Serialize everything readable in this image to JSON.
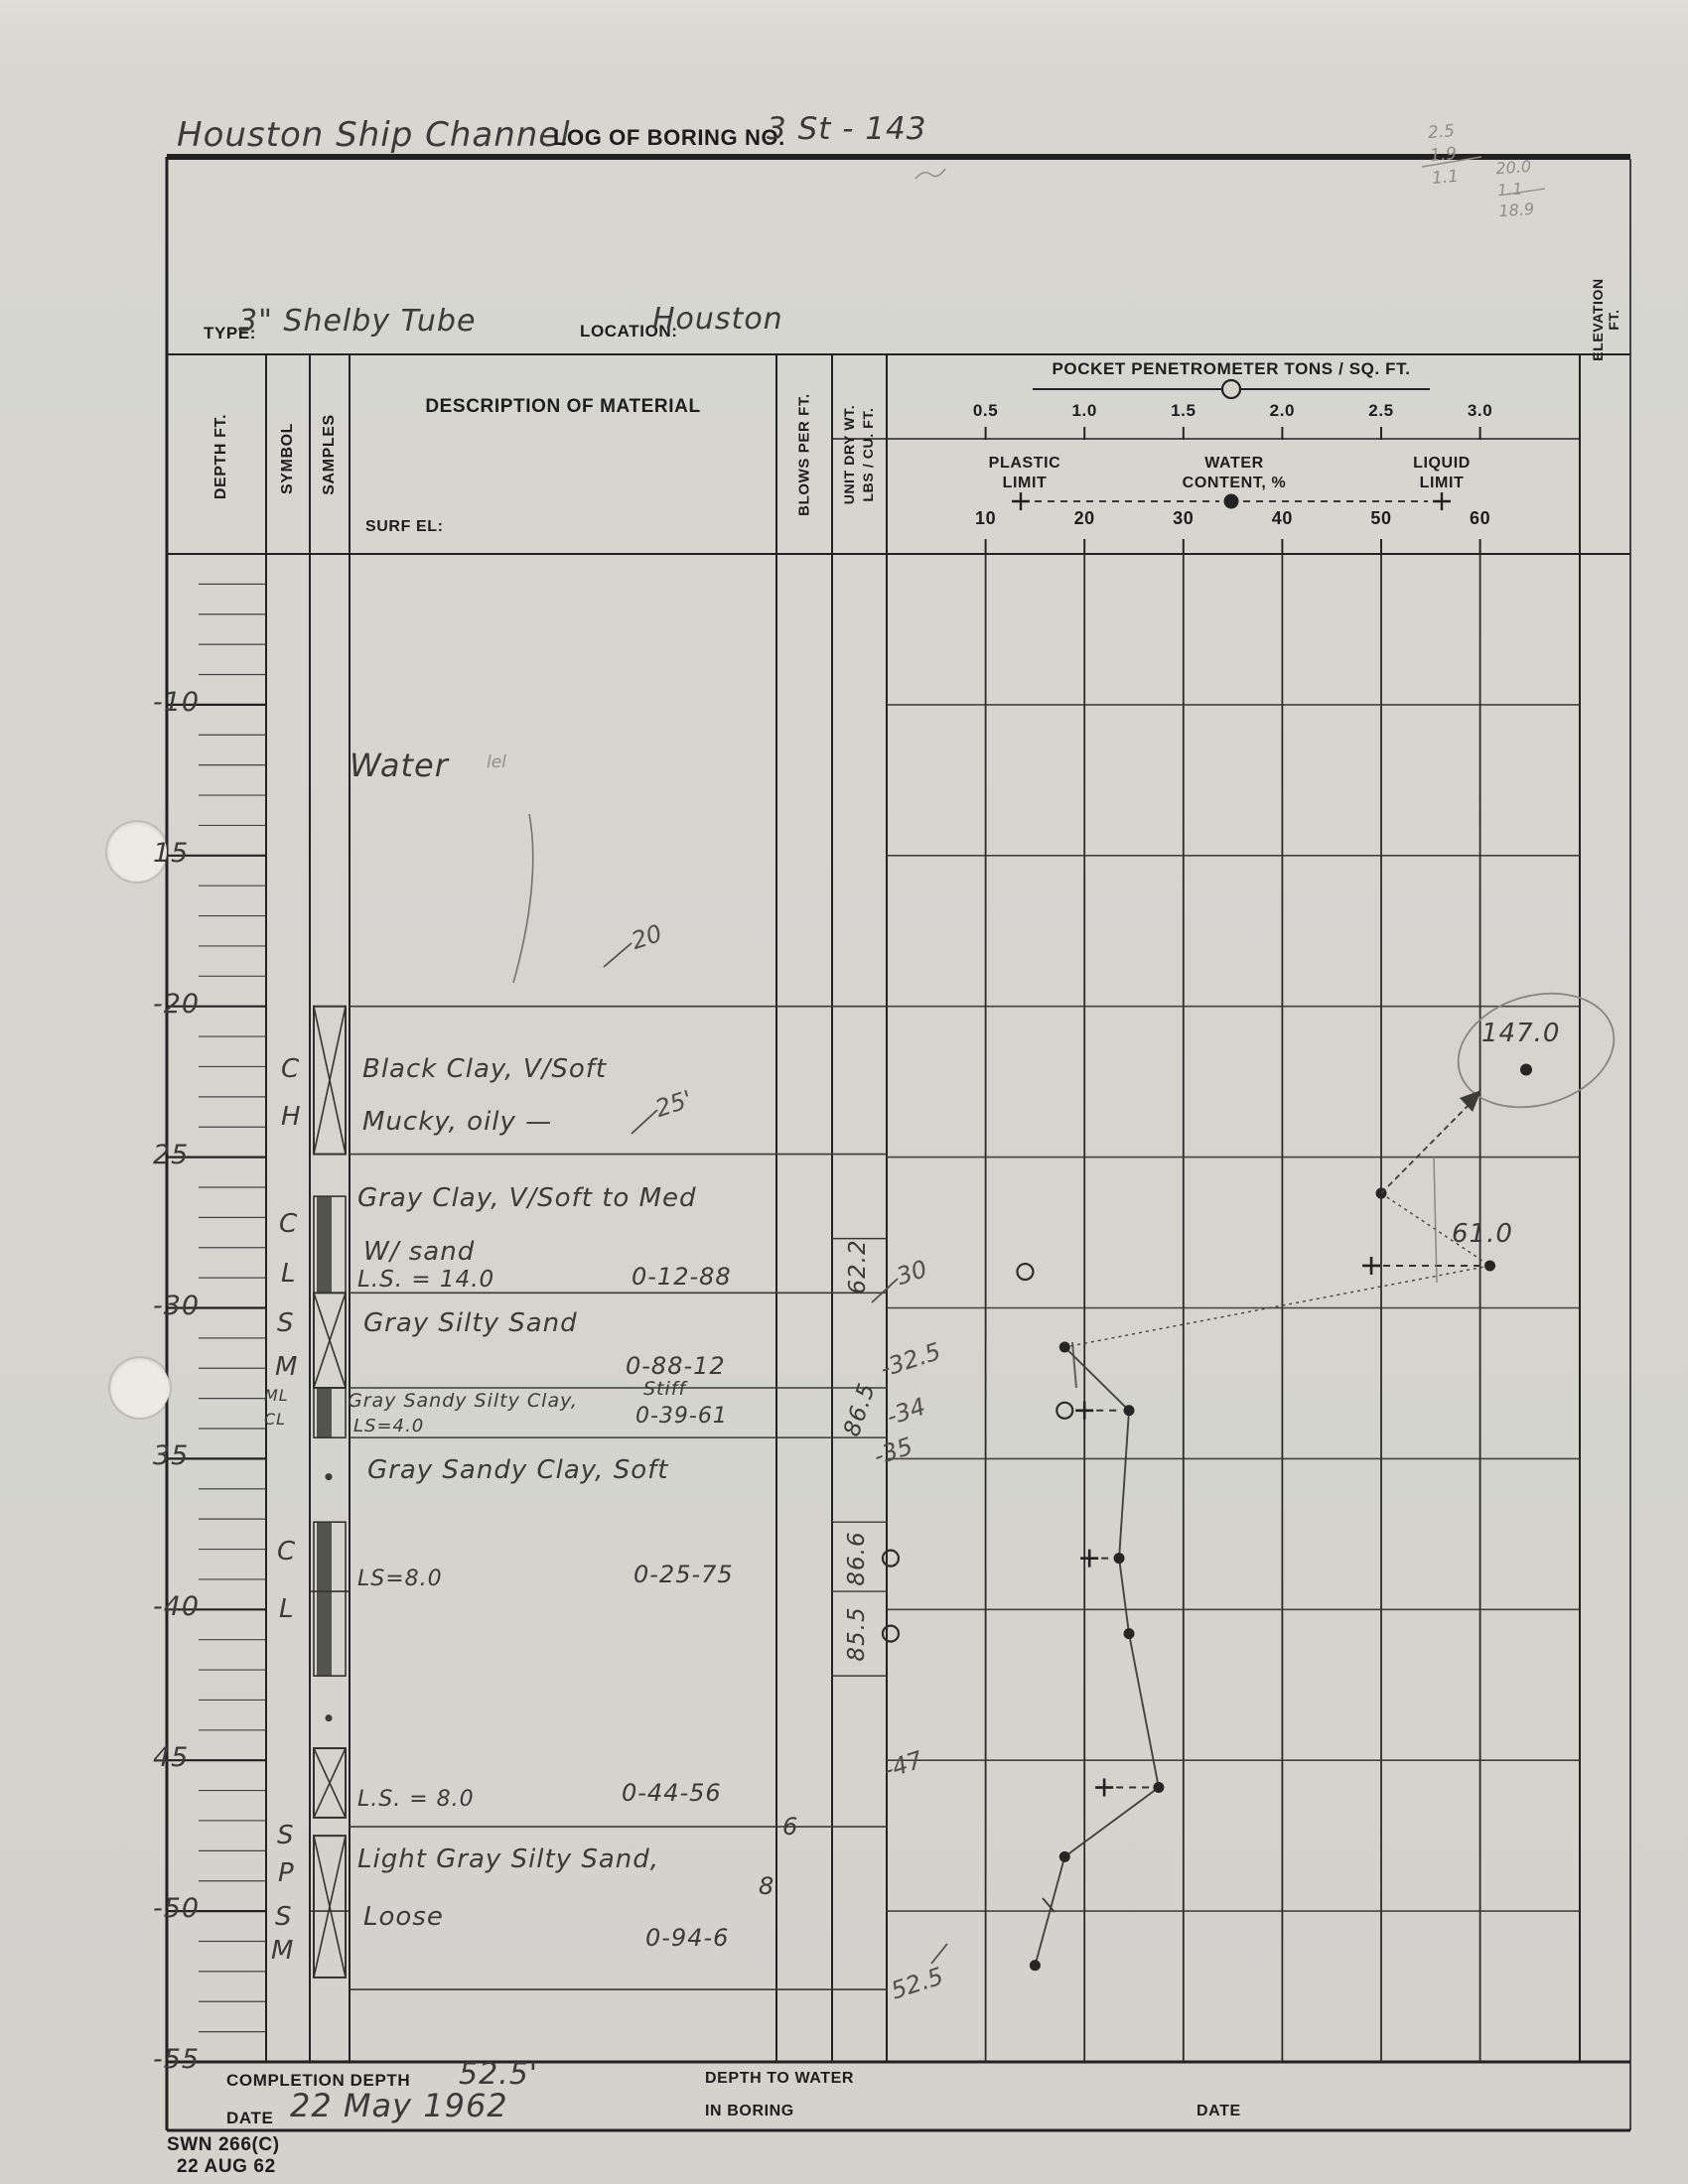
{
  "title": {
    "project": "Houston Ship Channel",
    "boring_label": "LOG OF BORING NO.",
    "boring_no": "3 St - 143"
  },
  "pencil_notes_top": {
    "col1": [
      "2.5",
      "1.9",
      "1.1"
    ],
    "col2": [
      "20.0",
      "1.1",
      "18.9"
    ]
  },
  "type_row": {
    "type_label": "TYPE:",
    "type_value": "3\" Shelby Tube",
    "location_label": "LOCATION:",
    "location_value": "Houston"
  },
  "header": {
    "depth": "DEPTH FT.",
    "symbol": "SYMBOL",
    "samples": "SAMPLES",
    "description": "DESCRIPTION OF MATERIAL",
    "surf_el": "SURF EL:",
    "blows": "BLOWS PER FT.",
    "unit_dry_wt": "UNIT DRY WT.\nLBS / CU. FT.",
    "elevation": "ELEVATION FT.",
    "pen_title": "POCKET PENETROMETER  TONS / SQ. FT.",
    "plastic_limit": "PLASTIC\nLIMIT",
    "water_content": "WATER\nCONTENT, %",
    "liquid_limit": "LIQUID\nLIMIT"
  },
  "depth_labels": [
    {
      "d": 10,
      "t": "-10"
    },
    {
      "d": 15,
      "t": "15"
    },
    {
      "d": 20,
      "t": "-20"
    },
    {
      "d": 25,
      "t": "25"
    },
    {
      "d": 30,
      "t": "-30"
    },
    {
      "d": 35,
      "t": "35"
    },
    {
      "d": 40,
      "t": "-40"
    },
    {
      "d": 45,
      "t": "45"
    },
    {
      "d": 50,
      "t": "-50"
    },
    {
      "d": 55,
      "t": "-55"
    }
  ],
  "log": {
    "entries": [
      {
        "t": "Water",
        "x": 352,
        "y": 752,
        "fs": 32,
        "cls": "hw"
      },
      {
        "t": "lel",
        "x": 490,
        "y": 758,
        "fs": 17,
        "cls": "pencil"
      },
      {
        "t": "Black Clay, V/Soft",
        "x": 365,
        "y": 1062,
        "fs": 26,
        "cls": "hw"
      },
      {
        "t": "Mucky, oily —",
        "x": 365,
        "y": 1115,
        "fs": 26,
        "cls": "hw"
      },
      {
        "t": "Gray Clay, V/Soft to Med",
        "x": 360,
        "y": 1192,
        "fs": 26,
        "cls": "hw"
      },
      {
        "t": "W/ sand",
        "x": 366,
        "y": 1246,
        "fs": 26,
        "cls": "hw"
      },
      {
        "t": "L.S. = 14.0",
        "x": 360,
        "y": 1276,
        "fs": 23,
        "cls": "hw"
      },
      {
        "t": "0-12-88",
        "x": 636,
        "y": 1272,
        "fs": 24,
        "cls": "hw"
      },
      {
        "t": "Gray Silty Sand",
        "x": 366,
        "y": 1318,
        "fs": 26,
        "cls": "hw"
      },
      {
        "t": "0-88-12",
        "x": 630,
        "y": 1362,
        "fs": 24,
        "cls": "hw"
      },
      {
        "t": "Gray Sandy Silty Clay,",
        "x": 350,
        "y": 1400,
        "fs": 19,
        "cls": "hw"
      },
      {
        "t": "Stiff",
        "x": 648,
        "y": 1388,
        "fs": 19,
        "cls": "hw"
      },
      {
        "t": "LS=4.0",
        "x": 356,
        "y": 1426,
        "fs": 18,
        "cls": "hw"
      },
      {
        "t": "0-39-61",
        "x": 640,
        "y": 1414,
        "fs": 22,
        "cls": "hw"
      },
      {
        "t": "Gray Sandy Clay, Soft",
        "x": 370,
        "y": 1466,
        "fs": 26,
        "cls": "hw"
      },
      {
        "t": "LS=8.0",
        "x": 360,
        "y": 1578,
        "fs": 22,
        "cls": "hw"
      },
      {
        "t": "0-25-75",
        "x": 638,
        "y": 1572,
        "fs": 24,
        "cls": "hw"
      },
      {
        "t": "L.S. = 8.0",
        "x": 360,
        "y": 1800,
        "fs": 22,
        "cls": "hw"
      },
      {
        "t": "0-44-56",
        "x": 626,
        "y": 1792,
        "fs": 24,
        "cls": "hw"
      },
      {
        "t": "6",
        "x": 788,
        "y": 1826,
        "fs": 24,
        "cls": "hw"
      },
      {
        "t": "Light Gray Silty Sand,",
        "x": 360,
        "y": 1858,
        "fs": 26,
        "cls": "hw"
      },
      {
        "t": "Loose",
        "x": 366,
        "y": 1916,
        "fs": 26,
        "cls": "hw"
      },
      {
        "t": "8",
        "x": 764,
        "y": 1886,
        "fs": 24,
        "cls": "hw"
      },
      {
        "t": "0-94-6",
        "x": 650,
        "y": 1938,
        "fs": 24,
        "cls": "hw"
      }
    ],
    "symbols": [
      {
        "t": "C",
        "x": 283,
        "y": 1062,
        "fs": 26
      },
      {
        "t": "H",
        "x": 283,
        "y": 1110,
        "fs": 26
      },
      {
        "t": "C",
        "x": 281,
        "y": 1218,
        "fs": 26
      },
      {
        "t": "L",
        "x": 283,
        "y": 1268,
        "fs": 26
      },
      {
        "t": "S",
        "x": 279,
        "y": 1318,
        "fs": 26
      },
      {
        "t": "M",
        "x": 277,
        "y": 1362,
        "fs": 26
      },
      {
        "t": "ML",
        "x": 266,
        "y": 1396,
        "fs": 16
      },
      {
        "t": "CL",
        "x": 266,
        "y": 1420,
        "fs": 16
      },
      {
        "t": "C",
        "x": 279,
        "y": 1548,
        "fs": 26
      },
      {
        "t": "L",
        "x": 281,
        "y": 1606,
        "fs": 26
      },
      {
        "t": "S",
        "x": 279,
        "y": 1834,
        "fs": 26
      },
      {
        "t": "P",
        "x": 280,
        "y": 1872,
        "fs": 26
      },
      {
        "t": "S",
        "x": 277,
        "y": 1916,
        "fs": 26
      },
      {
        "t": "M",
        "x": 273,
        "y": 1950,
        "fs": 26
      }
    ],
    "unit_weights": [
      {
        "v": "62.2",
        "cx": 864,
        "cy": 1276,
        "rot": -90
      },
      {
        "v": "86.5",
        "cx": 866,
        "cy": 1420,
        "rot": -72
      },
      {
        "v": "86.6",
        "cx": 863,
        "cy": 1570,
        "rot": -90
      },
      {
        "v": "85.5",
        "cx": 863,
        "cy": 1646,
        "rot": -90
      }
    ],
    "layer_boundaries_depth": [
      20,
      24.9,
      29.5,
      32.65,
      34.3,
      47.2,
      52.6
    ],
    "unitwt_cell_lines_depth": [
      27.7,
      37.1,
      39.4,
      42.2
    ],
    "samples_x_boxes": [
      [
        20,
        24.9
      ],
      [
        29.5,
        32.65
      ],
      [
        44.6,
        46.9
      ],
      [
        47.5,
        52.2
      ]
    ],
    "samples_bars": [
      [
        26.3,
        29.5
      ],
      [
        32.65,
        34.3
      ],
      [
        37.1,
        42.2
      ]
    ],
    "samples_joints_depth": [
      39.4,
      50.0
    ],
    "samples_dots_depth": [
      35.6,
      43.6
    ]
  },
  "chart_data": {
    "type": "scatter",
    "title": "Boring log profile: water content, Atterberg limits and pocket penetrometer vs depth",
    "x_axis_top": {
      "label": "POCKET PENETROMETER  TONS / SQ. FT.",
      "ticks": [
        0.5,
        1.0,
        1.5,
        2.0,
        2.5,
        3.0
      ]
    },
    "x_axis_bottom": {
      "label": "WATER CONTENT, %",
      "ticks": [
        10,
        20,
        30,
        40,
        50,
        60
      ]
    },
    "y_axis": {
      "label": "DEPTH FT.",
      "range": [
        5,
        55
      ],
      "tick_every": 5
    },
    "grid": true,
    "series": [
      {
        "name": "water_content_pct",
        "marker": "filled-dot",
        "connected": true,
        "points": [
          {
            "depth": 26.2,
            "value": 50
          },
          {
            "depth": 28.6,
            "value": 61,
            "label": "61.0"
          },
          {
            "depth": 31.3,
            "value": 18
          },
          {
            "depth": 33.4,
            "value": 24.5
          },
          {
            "depth": 38.3,
            "value": 23.5
          },
          {
            "depth": 40.8,
            "value": 24.5
          },
          {
            "depth": 45.9,
            "value": 27.5
          },
          {
            "depth": 48.2,
            "value": 18
          },
          {
            "depth": 51.8,
            "value": 15
          }
        ]
      },
      {
        "name": "plastic_limit_pct",
        "marker": "plus",
        "connected": false,
        "points": [
          {
            "depth": 28.6,
            "value": 49
          },
          {
            "depth": 33.4,
            "value": 20
          },
          {
            "depth": 38.3,
            "value": 20.5
          },
          {
            "depth": 45.9,
            "value": 22
          }
        ]
      },
      {
        "name": "pocket_penetrometer_tsf",
        "marker": "open-circle",
        "connected": false,
        "points": [
          {
            "depth": 28.8,
            "value": 0.7
          },
          {
            "depth": 33.4,
            "value": 0.9
          },
          {
            "depth": 38.3,
            "value": 0.02
          },
          {
            "depth": 40.8,
            "value": 0.02
          }
        ]
      }
    ],
    "offscale_annotation": {
      "depth": 22.1,
      "value": 147.0,
      "label": "147.0",
      "circled": true
    },
    "depth_annotations": [
      {
        "t": "20",
        "x": 636,
        "y": 930,
        "slash": [
          608,
          974,
          636,
          950
        ]
      },
      {
        "t": "25'",
        "x": 660,
        "y": 1098,
        "slash": [
          636,
          1142,
          662,
          1118
        ]
      },
      {
        "t": "30",
        "x": 903,
        "y": 1268,
        "slash": [
          878,
          1312,
          904,
          1288
        ]
      },
      {
        "t": "-32.5",
        "x": 886,
        "y": 1356
      },
      {
        "t": "-34",
        "x": 893,
        "y": 1408
      },
      {
        "t": "-35",
        "x": 880,
        "y": 1448
      },
      {
        "t": "-47",
        "x": 890,
        "y": 1764
      },
      {
        "t": "52.5",
        "x": 897,
        "y": 1984,
        "slash": [
          938,
          1978,
          954,
          1958
        ]
      }
    ]
  },
  "footer": {
    "completion_label": "COMPLETION DEPTH",
    "completion_value": "52.5'",
    "date_label": "DATE",
    "date_value": "22 May 1962",
    "depth_to_water_line1": "DEPTH TO WATER",
    "depth_to_water_line2": "IN BORING",
    "date2_label": "DATE"
  },
  "form": {
    "number": "SWN 266(C)",
    "date": "22 AUG 62"
  },
  "colors": {
    "paper": "#d5d4cf",
    "ink": "#1d1d1d",
    "handwriting": "#3a3a38",
    "pencil": "#8f8d84",
    "grid": "#2e2e2c"
  }
}
